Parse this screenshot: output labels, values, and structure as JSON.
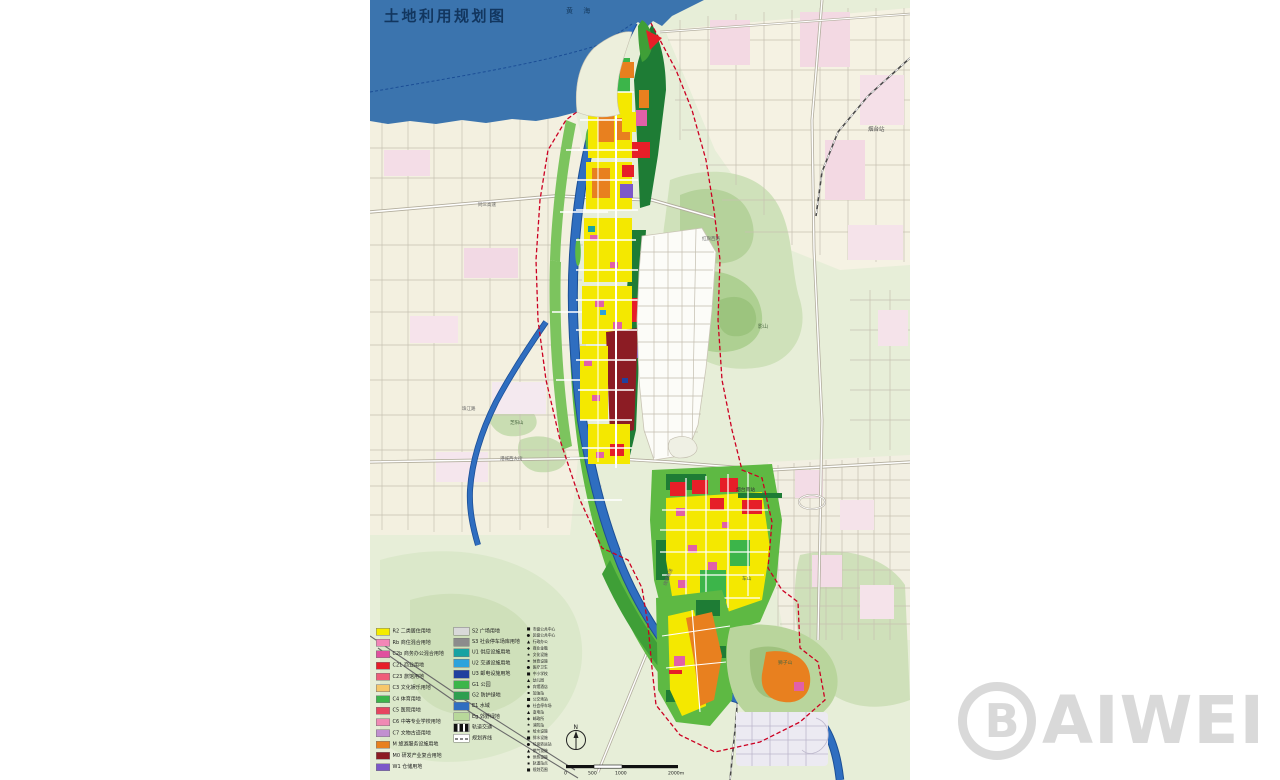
{
  "title": "土地利用规划图",
  "sea": {
    "name": "黄  海"
  },
  "map_labels": {
    "yantai_station": "烟台站",
    "hongqi_west_road": "红旗西路",
    "ying_mountain": "影山",
    "tongsan_expressway": "同三高速",
    "zhujiang_road": "珠江路",
    "zhiyang_mountain": "芝阳山",
    "gangcheng_west_street": "港城西大街",
    "yantai_south_station": "烟台南站",
    "che_mountain": "车山",
    "shizi_mountain": "狮子山",
    "raocheng_expressway": "绕城高速"
  },
  "legend": {
    "column1": [
      {
        "color": "#f5ec00",
        "label": "R2 二类居住用地"
      },
      {
        "color": "#f287b7",
        "label": "Rb 商住混合用地"
      },
      {
        "color": "#e0509e",
        "label": "C2b 商务办公混合用地"
      },
      {
        "color": "#e61e28",
        "label": "C21 商业用地"
      },
      {
        "color": "#ef5d7a",
        "label": "C23 旅馆用地"
      },
      {
        "color": "#f6c76a",
        "label": "C3 文化娱乐用地"
      },
      {
        "color": "#3cb54a",
        "label": "C4 体育用地"
      },
      {
        "color": "#e64560",
        "label": "C5 医院用地"
      },
      {
        "color": "#f08ab4",
        "label": "C6 中等专业学校用地"
      },
      {
        "color": "#c18fd0",
        "label": "C7 文物古迹用地"
      },
      {
        "color": "#e8801f",
        "label": "M 旅游服务设施用地"
      },
      {
        "color": "#8c1c24",
        "label": "M0 研发产业复合用地"
      },
      {
        "color": "#7c58c9",
        "label": "W1 仓储用地"
      }
    ],
    "column2": [
      {
        "color": "#d9d9d9",
        "label": "S2 广场用地"
      },
      {
        "color": "#8c8c8c",
        "label": "S3 社会停车场库用地"
      },
      {
        "color": "#17a2a2",
        "label": "U1 供应设施用地"
      },
      {
        "color": "#2ba3dc",
        "label": "U2 交通设施用地"
      },
      {
        "color": "#20409e",
        "label": "U3 邮电设施用地"
      },
      {
        "color": "#3cb54a",
        "label": "G1 公园"
      },
      {
        "color": "#2f9e50",
        "label": "G2 防护绿地"
      },
      {
        "color": "#2f6ec0",
        "label": "E1 水域"
      },
      {
        "color": "#b8d89a",
        "label": "Eg 郊野绿地"
      },
      {
        "type": "rail",
        "label": "轨道交通"
      },
      {
        "type": "boundary",
        "label": "规划界线"
      }
    ],
    "column3": [
      {
        "glyph": "■",
        "label": "市级公共中心"
      },
      {
        "glyph": "●",
        "label": "区级公共中心"
      },
      {
        "glyph": "▲",
        "label": "行政办公"
      },
      {
        "glyph": "◆",
        "label": "商业金融"
      },
      {
        "glyph": "★",
        "label": "文化设施"
      },
      {
        "glyph": "▪",
        "label": "体育设施"
      },
      {
        "glyph": "●",
        "label": "医疗卫生"
      },
      {
        "glyph": "■",
        "label": "中小学校"
      },
      {
        "glyph": "▲",
        "label": "幼儿园"
      },
      {
        "glyph": "◆",
        "label": "宾馆酒店"
      },
      {
        "glyph": "▪",
        "label": "加油站"
      },
      {
        "glyph": "■",
        "label": "公交场站"
      },
      {
        "glyph": "●",
        "label": "社会停车场"
      },
      {
        "glyph": "▲",
        "label": "变电站"
      },
      {
        "glyph": "◆",
        "label": "邮政所"
      },
      {
        "glyph": "★",
        "label": "消防站"
      },
      {
        "glyph": "▪",
        "label": "给水设施"
      },
      {
        "glyph": "■",
        "label": "排水设施"
      },
      {
        "glyph": "●",
        "label": "垃圾转运站"
      },
      {
        "glyph": "▲",
        "label": "燃气设施"
      },
      {
        "glyph": "◆",
        "label": "供热设施"
      },
      {
        "glyph": "▪",
        "label": "轨道站点"
      },
      {
        "glyph": "■",
        "label": "规划范围"
      }
    ]
  },
  "compass": {
    "north": "N"
  },
  "scale_bar": {
    "t0": "0",
    "t1": "500",
    "t2": "1000",
    "t3": "2000m"
  },
  "watermark": {
    "b": "B",
    "text": "AIWEI"
  },
  "colors": {
    "sea": "#3b74ae",
    "river": "#2f6ec0",
    "park_green": "#5eb943",
    "dark_green": "#1e7c35",
    "residential_yellow": "#f4e800",
    "commercial_red": "#e61e28",
    "rd_dark_red": "#8c1c24",
    "tourism_orange": "#e8801f",
    "school_magenta": "#e160a8",
    "warehouse_purple": "#7c58c9",
    "boundary_red": "#cc0022"
  }
}
